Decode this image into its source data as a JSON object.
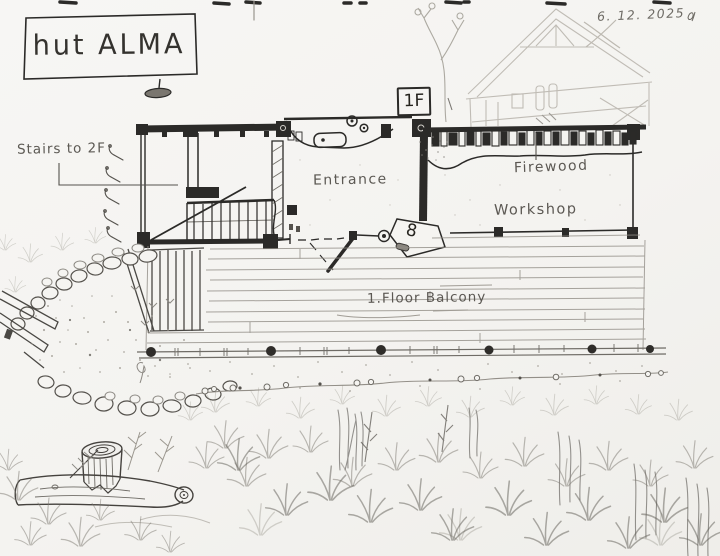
{
  "header": {
    "title": "hut ALMA",
    "date": "6. 12. 2025"
  },
  "plan": {
    "floor_tag": "1F",
    "labels": {
      "stairs": "Stairs to 2F",
      "entrance": "Entrance",
      "firewood": "Firewood",
      "workshop": "Workshop",
      "balcony": "1.Floor Balcony",
      "door_number": "8"
    }
  },
  "colors": {
    "ink": "#2b2a28",
    "pencil_dark": "#55524d",
    "pencil": "#8d8a84",
    "pencil_light": "#b5b1a9",
    "paper": "#f5f4f1"
  }
}
